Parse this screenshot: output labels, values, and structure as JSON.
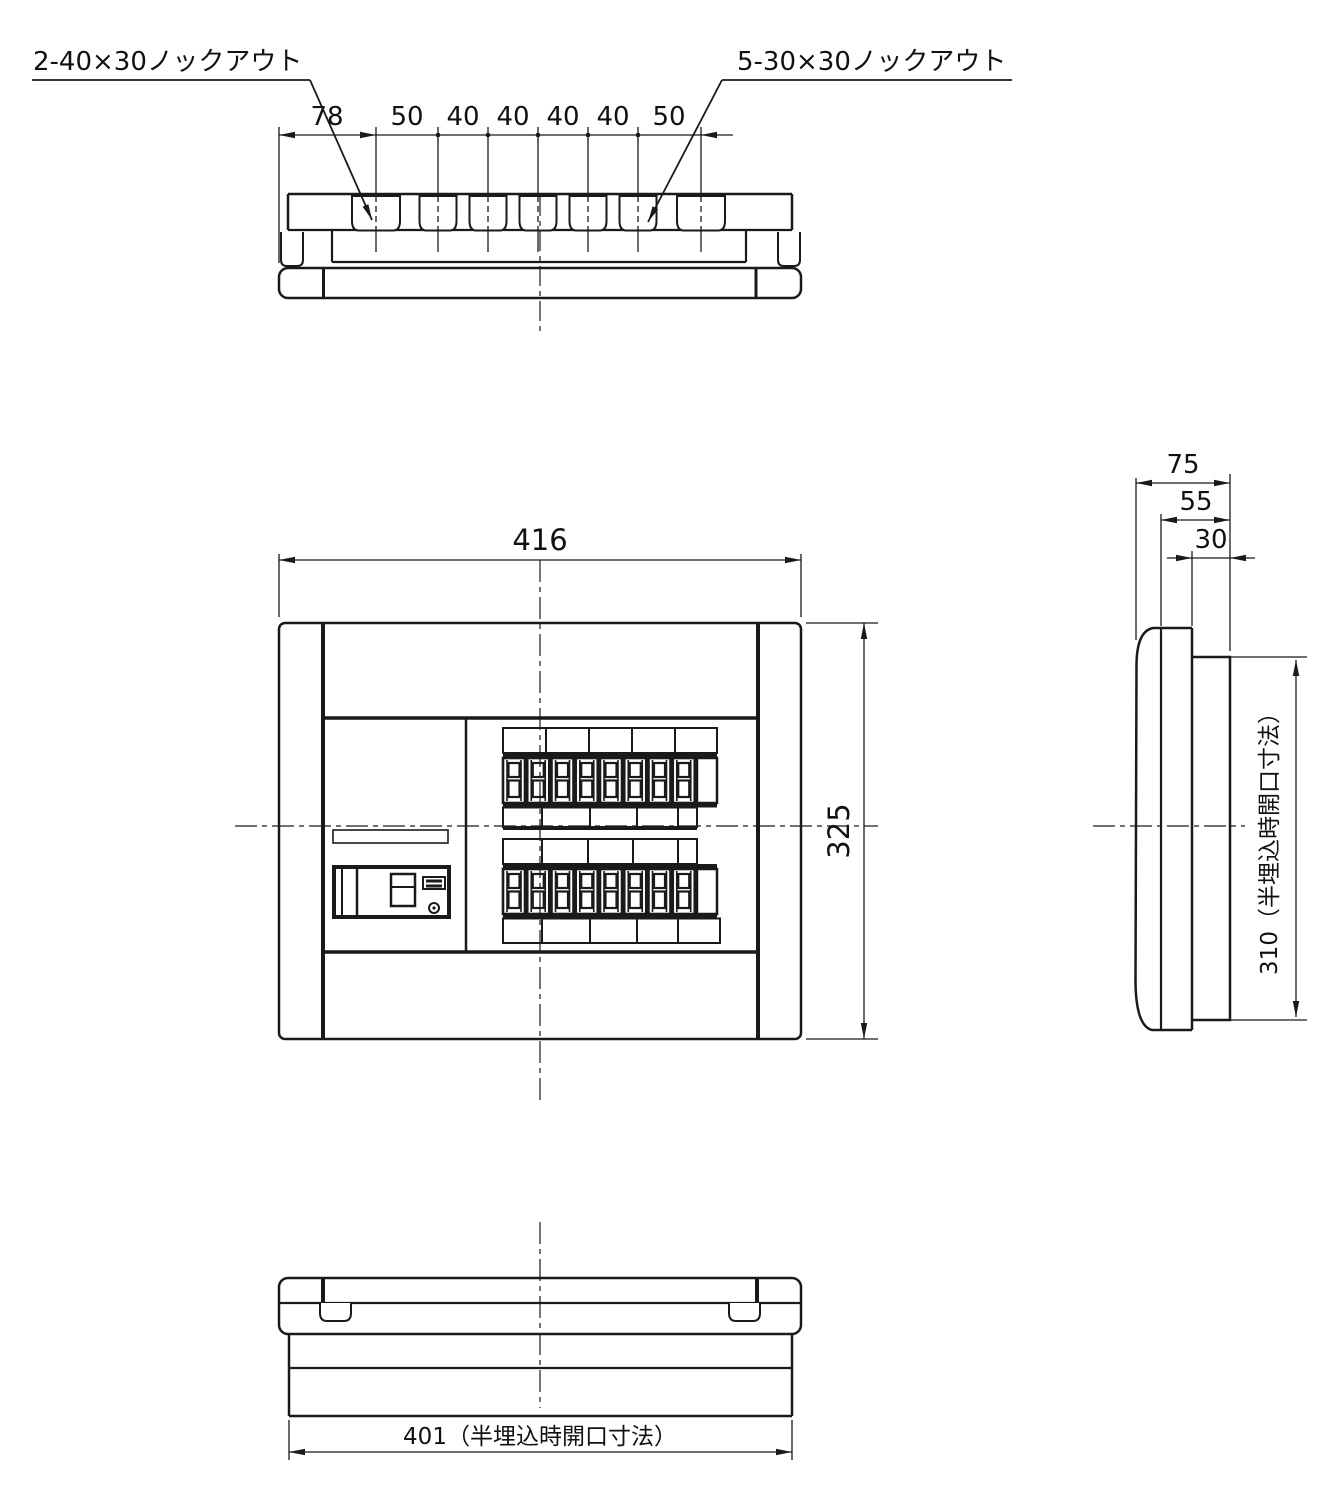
{
  "drawing": {
    "type": "technical-dimension-drawing",
    "subject": "electrical distribution board (4 orthographic views)",
    "colors": {
      "line": "#1a1a1a",
      "background": "#ffffff"
    },
    "callouts": {
      "knockout_top_left": "2-40×30ノックアウト",
      "knockout_top_right": "5-30×30ノックアウト"
    },
    "top_dim_chain": [
      "78",
      "50",
      "40",
      "40",
      "40",
      "40",
      "50"
    ],
    "front": {
      "width": "416",
      "height": "325"
    },
    "side": {
      "depth_overall": "75",
      "depth_cover": "55",
      "depth_body": "30",
      "opening_height": "310（半埋込時開口寸法）"
    },
    "bottom": {
      "opening_width": "401（半埋込時開口寸法）"
    }
  }
}
